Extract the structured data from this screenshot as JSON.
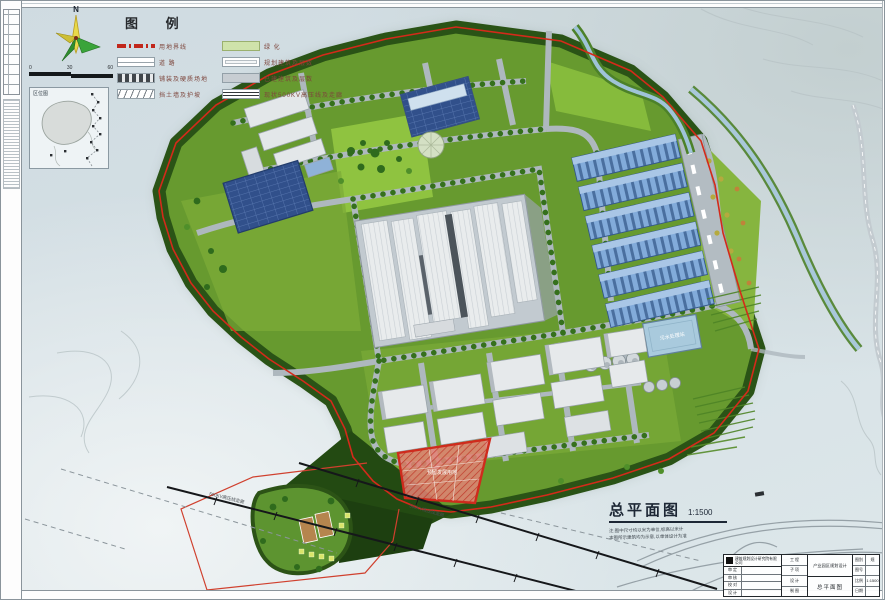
{
  "legend": {
    "title": "图 例",
    "items_left": [
      {
        "label": "用地界线"
      },
      {
        "label": "道  路"
      },
      {
        "label": "铺装及硬质场地"
      },
      {
        "label": "挡土墙及护坡"
      }
    ],
    "items_right": [
      {
        "label": "绿  化"
      },
      {
        "label": "规划建筑及层数"
      },
      {
        "label": "已建建筑及层数"
      },
      {
        "label": "现状500KV高压线及走廊"
      }
    ]
  },
  "compass": {
    "north_label": "N"
  },
  "scalebar": {
    "ticks": [
      "0",
      "30",
      "60"
    ]
  },
  "inset_map": {
    "title": "区位图"
  },
  "drawing_title": {
    "name": "总平面图",
    "scale": "1:1500",
    "note1": "注:图中尺寸均以米为单位,标高以米计",
    "note2": "本图所示建筑均为示意,以单体设计为准"
  },
  "map_labels": {
    "powerline1": "500KV高压线走廊",
    "powerline2": "500KV高压线走廊",
    "basin": "污水处理站",
    "parcel": "预留发展用地"
  },
  "titleblock": {
    "company": "建筑规划设计研究院有限公司",
    "sig_labels": [
      "审 定",
      "审 核",
      "校 对",
      "设 计"
    ],
    "mid_labels": [
      "工 程",
      "子 项",
      "设 计",
      "制 图"
    ],
    "project": "产业园区规划设计",
    "drawing": "总平面图",
    "field_labels": [
      "图别",
      "图号",
      "比例",
      "日期"
    ],
    "field_values": [
      "规",
      "",
      "1:1500",
      ""
    ]
  }
}
